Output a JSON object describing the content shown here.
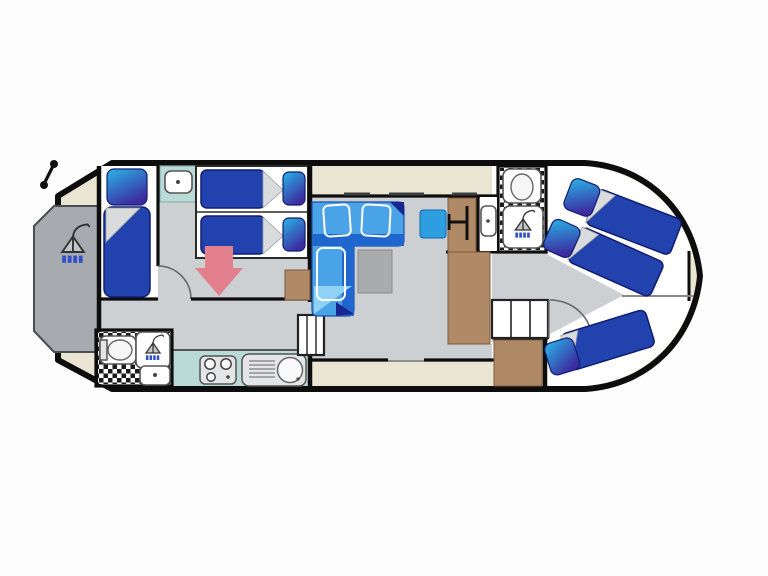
{
  "canvas": {
    "width": 768,
    "height": 576,
    "background": "#fdfdfd"
  },
  "colors": {
    "page-bg": "#fdfdfd",
    "hull-outline": "#0d0d0d",
    "deck-beige": "#e9e5d2",
    "aft-deck-gray": "#a7abb0",
    "floor-gray": "#ccd0d3",
    "room-white": "#ffffff",
    "bed-blue": "#2243ae",
    "bed-navy-edge": "#101c70",
    "pillow-cyan": "#29b6e8",
    "pillow-indigo": "#3c2ca0",
    "sofa-blue": "#4aa3e6",
    "sofa-dark": "#1f67cf",
    "sofa-light": "#8fd2f6",
    "table-gray": "#a9abad",
    "galley-teal": "#b9dad6",
    "cabinet-brown": "#b08a66",
    "arrow-pink": "#e2808e",
    "seat-blue": "#2d9fe0"
  },
  "plan": {
    "vessel": "houseboat-floor-plan",
    "decks": [
      "aft-sun-deck",
      "side-deck-walkway",
      "bow-anchor-locker"
    ],
    "rooms": [
      {
        "name": "aft-port-cabin",
        "furniture": [
          "single-bed"
        ]
      },
      {
        "name": "mid-cabin",
        "furniture": [
          "single-bed",
          "single-bed",
          "washbasin",
          "wardrobe",
          "convert-arrow"
        ]
      },
      {
        "name": "aft-bathroom",
        "furniture": [
          "toilet",
          "shower",
          "washbasin"
        ]
      },
      {
        "name": "galley",
        "furniture": [
          "stove",
          "sink-with-drainer"
        ]
      },
      {
        "name": "saloon",
        "furniture": [
          "l-shaped-sofa",
          "table",
          "companionway-steps",
          "windows"
        ]
      },
      {
        "name": "helm-station",
        "furniture": [
          "helm-seat",
          "steering-wheel",
          "console"
        ]
      },
      {
        "name": "forward-bathroom",
        "furniture": [
          "toilet",
          "shower",
          "washbasin"
        ]
      },
      {
        "name": "bow-cabin",
        "furniture": [
          "single-bed",
          "single-bed",
          "single-bed",
          "steps",
          "door"
        ]
      }
    ],
    "icons": [
      "shower-icon",
      "toilet-icon",
      "washbasin-icon",
      "stove-icon",
      "sink-icon",
      "steering-wheel-icon",
      "antenna-icon",
      "down-arrow-icon",
      "door-swing-icon"
    ]
  }
}
